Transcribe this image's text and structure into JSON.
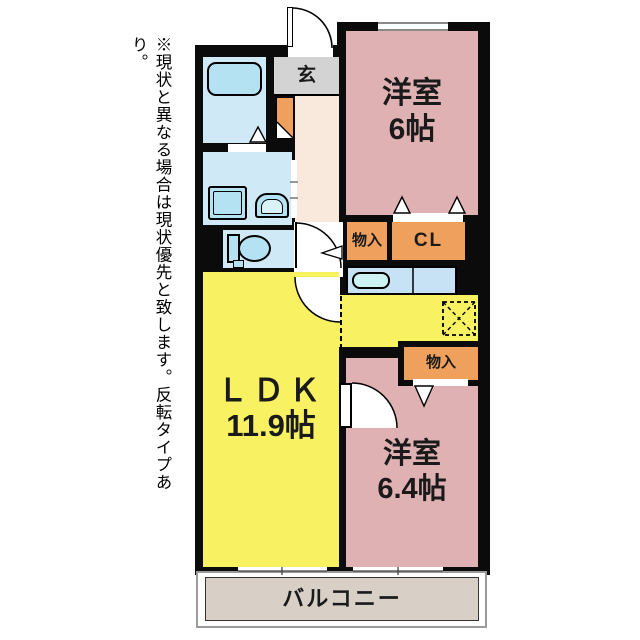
{
  "note": {
    "text": "※現状と異なる場合は現状優先と致します。反転タイプあり。"
  },
  "rooms": {
    "entrance": {
      "label": "玄"
    },
    "bedroom1": {
      "label": "洋室",
      "size": "6帖"
    },
    "bedroom2": {
      "label": "洋室",
      "size": "6.4帖"
    },
    "ldk": {
      "label": "ＬＤＫ",
      "size": "11.9帖"
    },
    "balcony": {
      "label": "バルコニー"
    }
  },
  "closets": {
    "storage1": {
      "label": "物入"
    },
    "cl": {
      "label": "CL"
    },
    "storage2": {
      "label": "物入"
    }
  },
  "colors": {
    "wall": "#0b0b0b",
    "bedroom_pink": "#e0b1b2",
    "ldk_yellow": "#f8f263",
    "closet_orange": "#efa05c",
    "wet_room_blue": "#cfe9f7",
    "fixture_blue": "#b5e2f2",
    "sink_blue": "#cdf2f4",
    "entrance_gray": "#d3d3d3",
    "hallway_cream": "#f9e8dc",
    "balcony_beige": "#d8d0c6",
    "counter_blue": "#c8e2f5"
  }
}
